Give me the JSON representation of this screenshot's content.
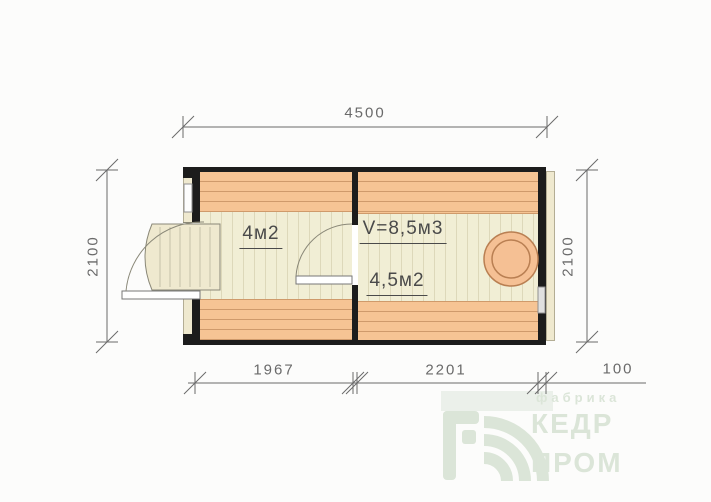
{
  "drawing": {
    "type": "floor-plan",
    "dimensions": {
      "width_top": "4500",
      "height_left": "2100",
      "height_right": "2100",
      "bottom_left": "1967",
      "bottom_middle": "2201",
      "bottom_right": "100"
    },
    "rooms": [
      {
        "id": "room-left",
        "area": "4м2"
      },
      {
        "id": "room-right",
        "volume": "V=8,5м3",
        "area": "4,5м2"
      }
    ],
    "colors": {
      "page_bg": "#fcfcfb",
      "wall": "#1c1c1c",
      "bench_fill": "#f6c494",
      "bench_line": "#cf9a6b",
      "floor_fill": "#f1eed5",
      "floor_line": "#ddd8ba",
      "trim_cream": "#efe9cf",
      "dim_line": "#6a6a6a",
      "label_text": "#4a4a4a",
      "stove_fill": "#f5c094",
      "stove_stroke": "#b97f52",
      "logo_green": "#dbe5d8"
    }
  },
  "logo": {
    "tagline": "фабрика",
    "word1": "КЕДР",
    "word2": "ПРОМ"
  }
}
